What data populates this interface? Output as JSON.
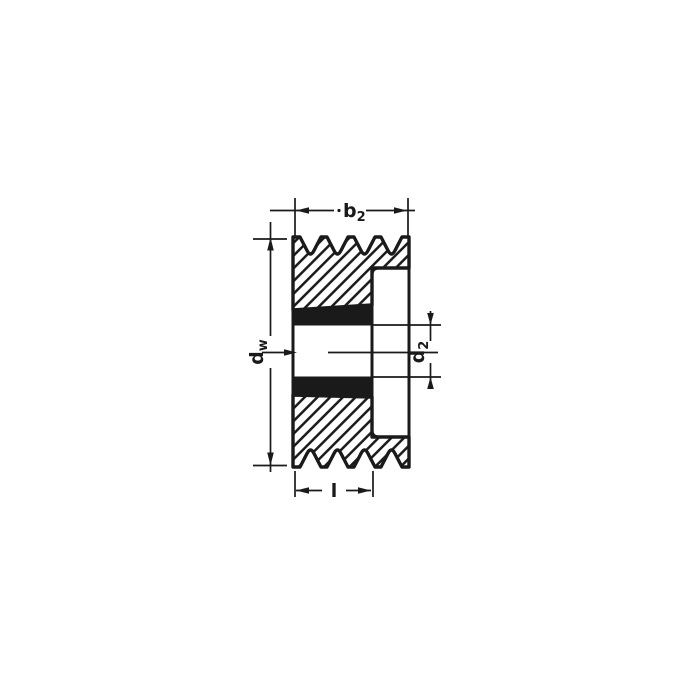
{
  "colors": {
    "ink": "#1a1a1a",
    "paper": "#ffffff"
  },
  "dimension_labels": {
    "rim_width": {
      "main": "b",
      "sub": "2"
    },
    "pitch_diameter": {
      "main": "d",
      "sub": "w"
    },
    "bore_diameter": {
      "main": "d",
      "sub": "2"
    },
    "hub_length": {
      "main": "l",
      "sub": ""
    }
  }
}
